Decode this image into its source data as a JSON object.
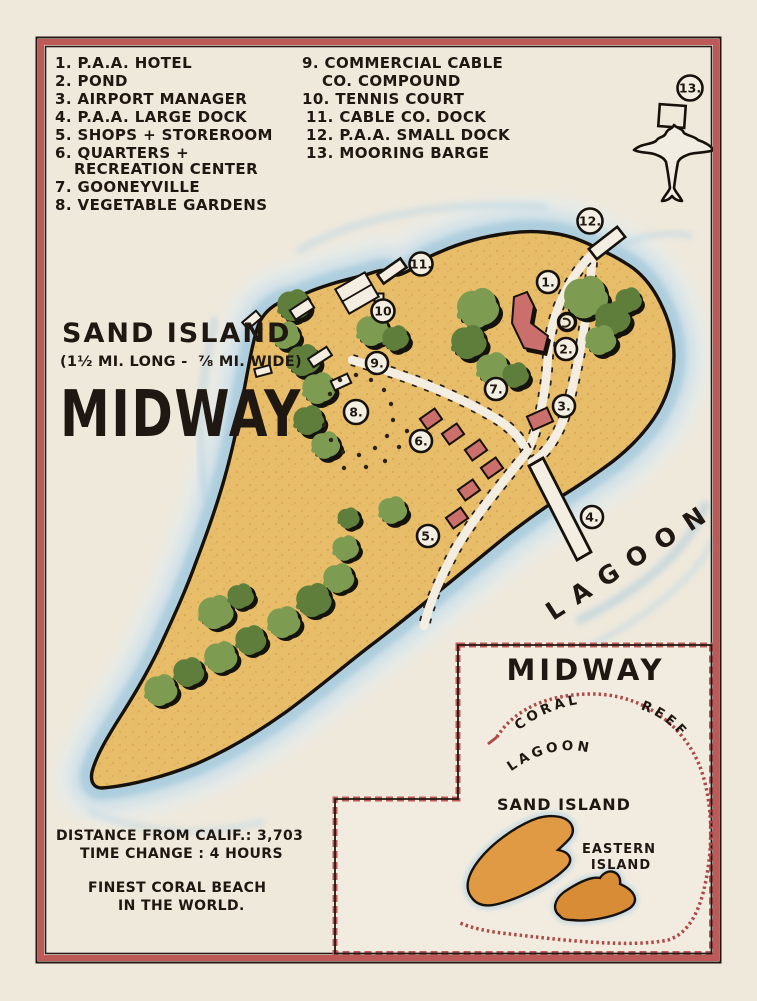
{
  "legend": {
    "left": [
      "1. P.A.A. HOTEL",
      "2. POND",
      "3. AIRPORT MANAGER",
      "4. P.A.A. LARGE DOCK",
      "5. SHOPS + STOREROOM",
      "6. QUARTERS +",
      "RECREATION CENTER",
      "7. GOONEYVILLE",
      "8. VEGETABLE GARDENS"
    ],
    "right": [
      "9. COMMERCIAL CABLE",
      "CO. COMPOUND",
      "10. TENNIS COURT",
      "11. CABLE CO. DOCK",
      "12. P.A.A. SMALL DOCK",
      "13. MOORING BARGE"
    ]
  },
  "island": {
    "title": "SAND ISLAND",
    "subtitle": "(1½ MI. LONG -  ⅞ MI. WIDE)",
    "name": "MIDWAY",
    "lagoon_label": "LAGOON"
  },
  "markers": [
    "1.",
    "2.",
    "3.",
    "4.",
    "5.",
    "6.",
    "7.",
    "8.",
    "9.",
    "10",
    "11.",
    "12.",
    "13."
  ],
  "notes": {
    "line1": "DISTANCE FROM CALIF.: 3,703",
    "line2": "TIME CHANGE : 4 HOURS",
    "line3": "FINEST CORAL BEACH",
    "line4": "IN THE WORLD."
  },
  "inset": {
    "title": "MIDWAY",
    "reef_label": "CORAL  REEF",
    "lagoon_label": "LAGOON",
    "sand_label": "SAND ISLAND",
    "eastern_line1": "EASTERN",
    "eastern_line2": "ISLAND"
  },
  "colors": {
    "paper": "#efe9dc",
    "frame_red": "#bd5a58",
    "sand": "#e7bd69",
    "water_blue": "#aecfe0",
    "tree_green": "#7d9b51",
    "building_red": "#ca6f6b",
    "reef_red": "#ad4a48",
    "ink": "#1f1711"
  }
}
